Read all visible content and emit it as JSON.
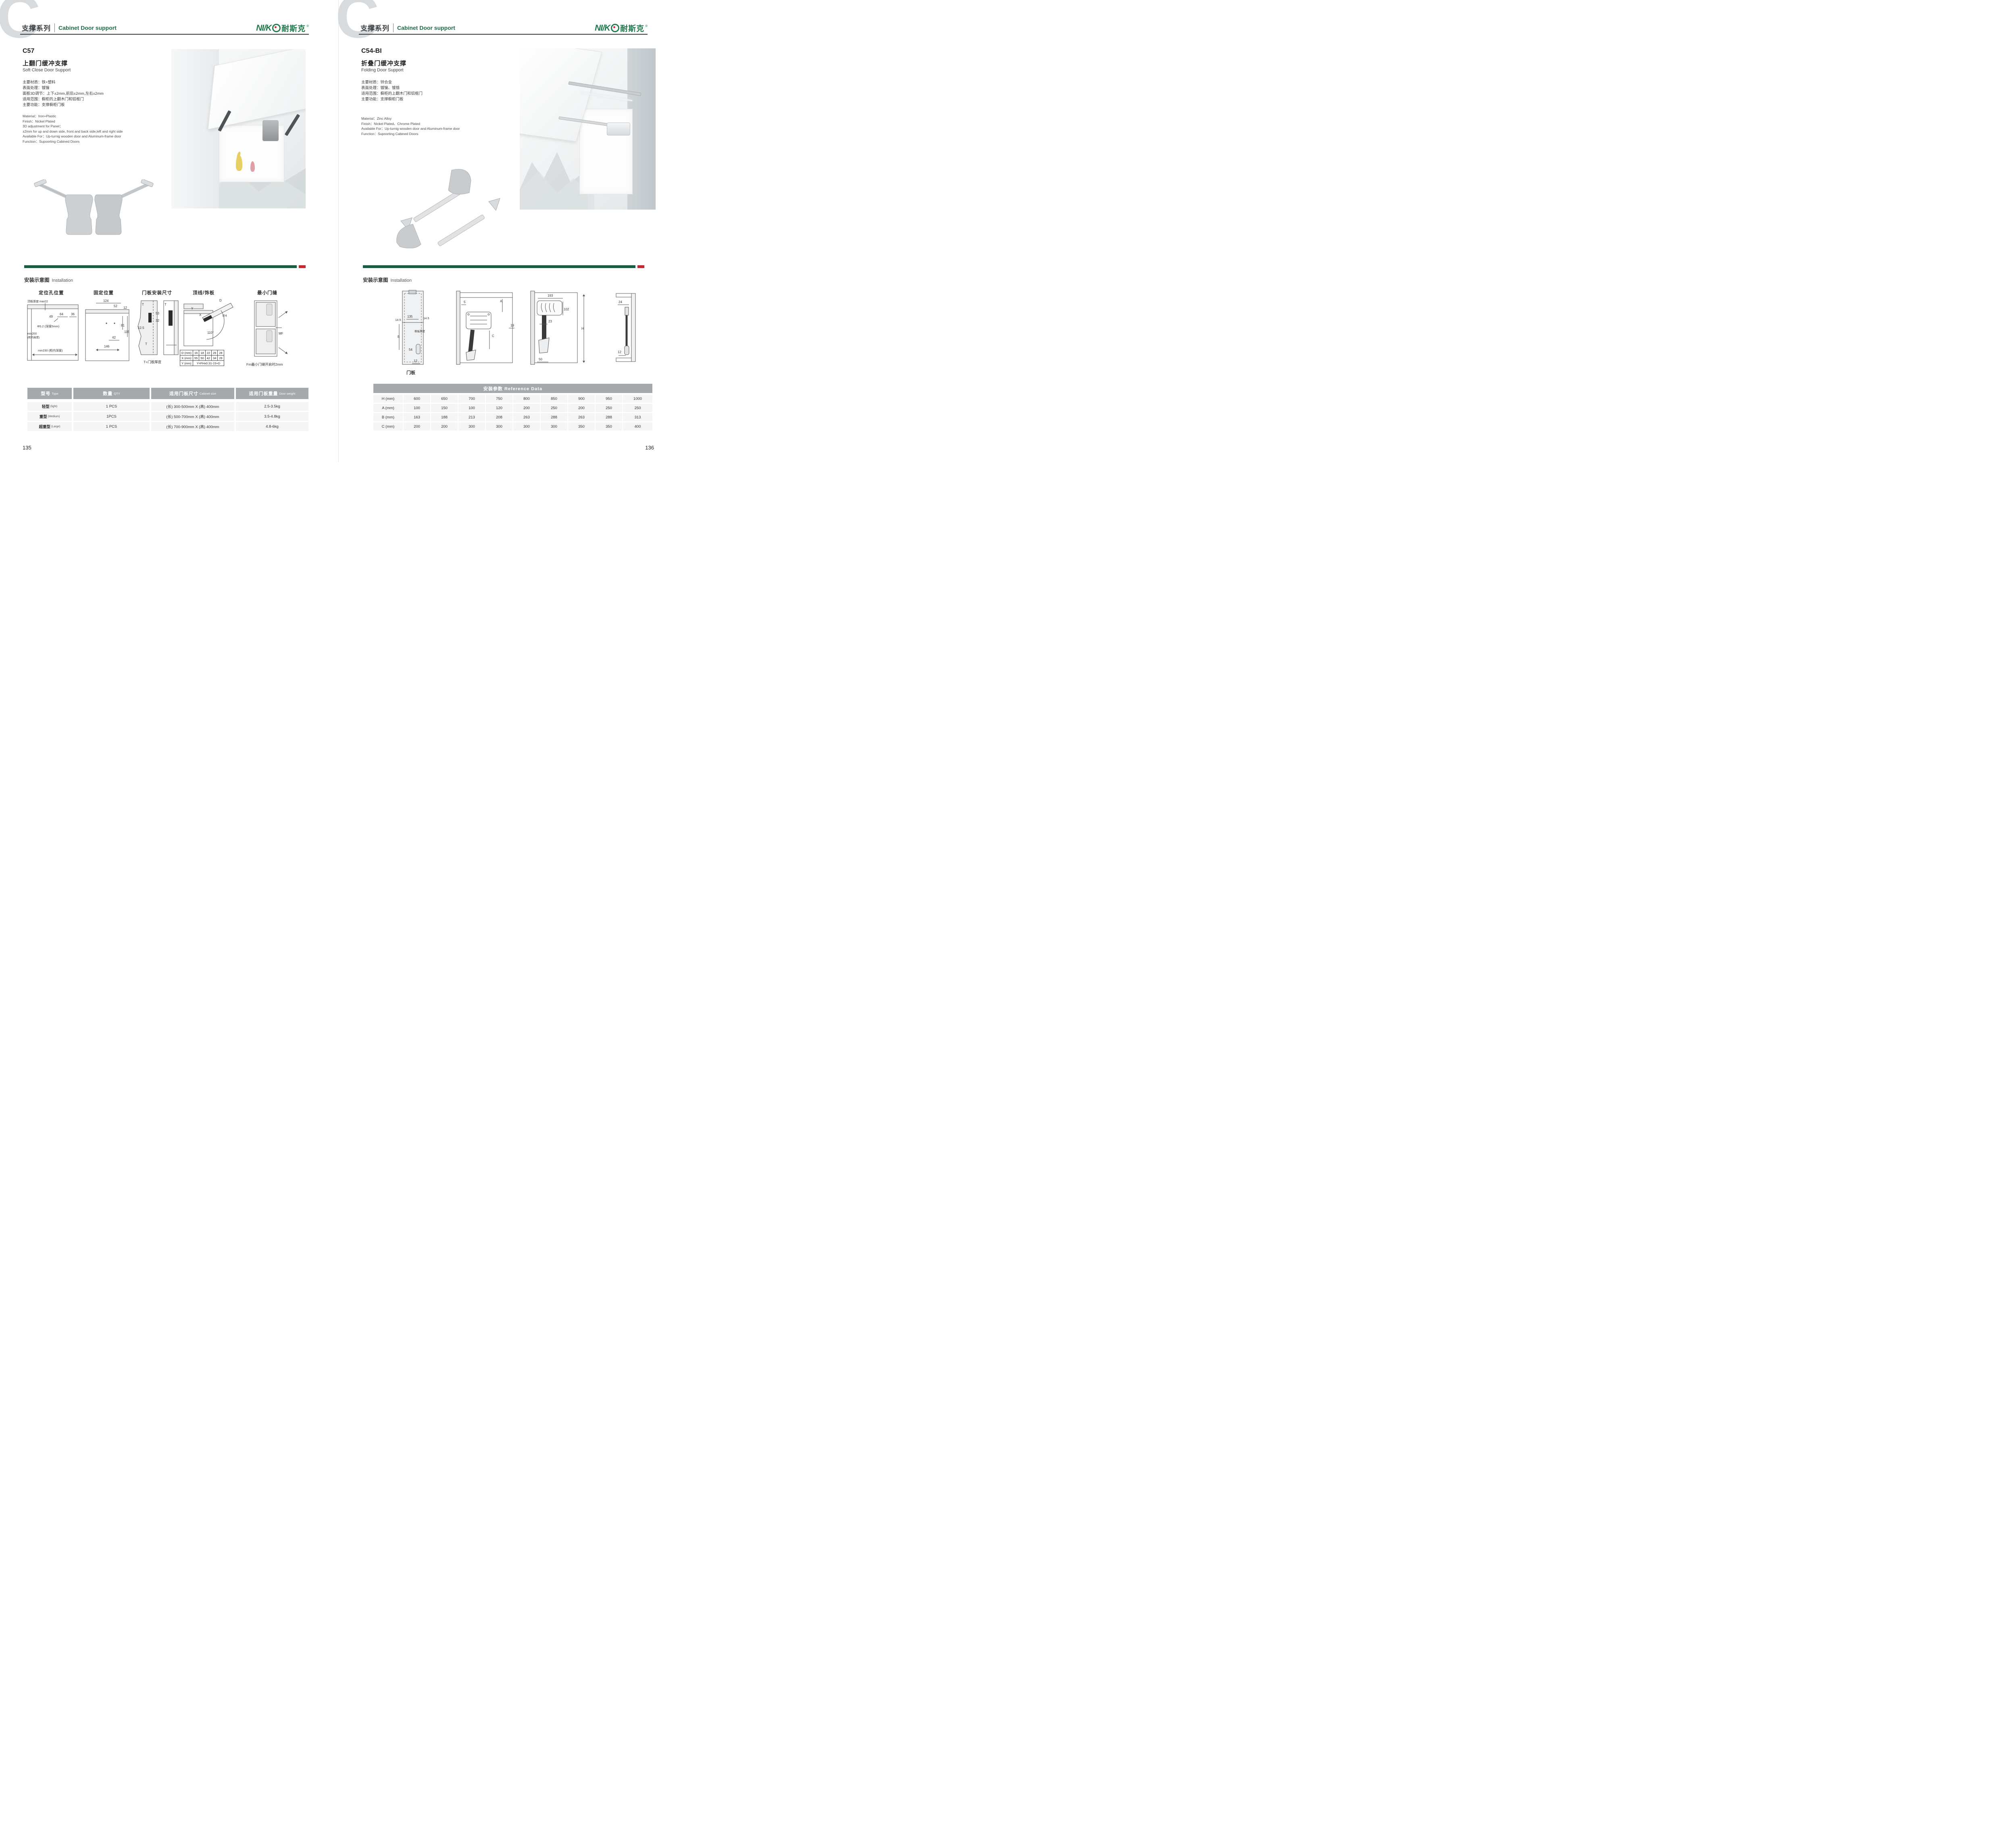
{
  "brand": {
    "logo_latin": "NI/K",
    "logo_cn": "耐斯克",
    "reg": "®",
    "green": "#1e7a4d",
    "red": "#d62b28"
  },
  "header": {
    "watermark": "C",
    "series_cn": "支撑系列",
    "series_en": "Cabinet Door support"
  },
  "install_section": {
    "label_cn": "安装示意图",
    "label_en": "Installation",
    "bar_green": "#1c5c42",
    "bar_red": "#bf2b30"
  },
  "left_page": {
    "model": "C57",
    "title_cn": "上翻门缓冲支撑",
    "title_en": "Soft Close Door Support",
    "specs_cn": [
      "主要材质：铁+塑料",
      "表面处理：镀镍",
      "面板3D调节：上下±2mm,前后±2mm,左右±2mm",
      "适用范围：橱柜的上翻木门和铝框门",
      "主要功能：支撑橱柜门板"
    ],
    "specs_en": [
      "Material：Iron+Plastic",
      "Finish：Nickel Plated",
      "3D adjustment for Panel：",
      "±2mm for up and down side, front and back side,left and right side",
      "Available For：Up-turnig wooden door and Aluminum-frame door",
      "Function：Supoorting Cabined Doors"
    ],
    "diagrams": {
      "d1": {
        "title": "定位孔位置",
        "top_label": "顶板厚度 max22",
        "dim_49": "49",
        "dim_64": "64",
        "dim_36": "36",
        "hole": "Φ5.2 (深度5mm)",
        "min200": "min200",
        "min200_sub": "(柜内高度)",
        "min230": "min230 (柜内深度)"
      },
      "d2": {
        "title": "固定位置",
        "dims": [
          "124",
          "52",
          "12",
          "81",
          "115",
          "42",
          "146"
        ]
      },
      "d3": {
        "title": "门板安装尺寸",
        "dims": [
          "T",
          "53",
          "32",
          "12.5",
          "T",
          "T"
        ],
        "note": "T=门板厚度"
      },
      "d4": {
        "title": "顶线/饰板",
        "dims": [
          "Y",
          "X",
          "D",
          "FH",
          "110°"
        ],
        "table": {
          "r0": [
            "D (mm)",
            "16",
            "18",
            "22",
            "26",
            "28"
          ],
          "r1": [
            "X (mm)",
            "55",
            "50",
            "42",
            "34",
            "29"
          ],
          "r2": [
            "Y (mm)",
            "Y=FHx0.31-15+D"
          ]
        }
      },
      "d5": {
        "title": "最小门缝",
        "mf": "MF",
        "note": "Fm最小门缝开启时2mm"
      }
    },
    "table": {
      "headers": [
        {
          "cn": "型号",
          "en": "Type"
        },
        {
          "cn": "数量",
          "en": "QTY"
        },
        {
          "cn": "适用门板尺寸",
          "en": "Cabinet size"
        },
        {
          "cn": "适用门板重量",
          "en": "Door weight"
        }
      ],
      "rows": [
        {
          "type_cn": "轻型",
          "type_en": "(light)",
          "qty": "1 PCS",
          "size": "(长) 300-500mm X (高) 400mm",
          "weight": "2.5-3.5kg"
        },
        {
          "type_cn": "重型",
          "type_en": "(Medium)",
          "qty": "1PCS",
          "size": "(长) 500-700mm X (高) 400mm",
          "weight": "3.5-4.8kg"
        },
        {
          "type_cn": "超重型",
          "type_en": "(Large)",
          "qty": "1 PCS",
          "size": "(长) 700-900mm X (高) 400mm",
          "weight": "4.8-6kg"
        }
      ]
    },
    "page_number": "135"
  },
  "right_page": {
    "model": "C54-BI",
    "title_cn": "折叠门缓冲支撑",
    "title_en": "Folding Door Support",
    "specs_cn": [
      "主要材质：锌合金",
      "表面处理：镀镍、镀铬",
      "适用范围：橱柜的上翻木门和铝框门",
      "主要功能：支撑橱柜门板"
    ],
    "specs_en": [
      "Material：Zinc Alloy",
      "Finish：Nickel Plated、Chrome Plated",
      "Available For：Up-turnig wooden door and Aluminum-frame door",
      "Function：Supoorting Cabined Doors"
    ],
    "diagrams": {
      "d1": {
        "label": "门板",
        "dim_135": "135",
        "dim_145l": "14.5",
        "dim_145r": "14.5",
        "dim_B": "B",
        "side_label": "侧板厚度",
        "dim_54": "54",
        "dim_12": "12"
      },
      "d2": {
        "dim_5": "5",
        "dim_A": "A",
        "dim_C": "C",
        "dim_19": "19"
      },
      "d3": {
        "dim_193": "193",
        "dim_102": "102",
        "dim_23": "23",
        "dim_H": "H",
        "dim_50": "50"
      },
      "d4": {
        "dim_24": "24",
        "dim_12": "12"
      }
    },
    "table": {
      "title": "安装参数 Reference Data",
      "rows": [
        {
          "label": "H (mm)",
          "values": [
            "600",
            "650",
            "700",
            "750",
            "800",
            "850",
            "900",
            "950",
            "1000"
          ]
        },
        {
          "label": "A (mm)",
          "values": [
            "100",
            "150",
            "100",
            "120",
            "200",
            "250",
            "200",
            "250",
            "250"
          ]
        },
        {
          "label": "B (mm)",
          "values": [
            "163",
            "188",
            "213",
            "208",
            "263",
            "288",
            "263",
            "288",
            "313"
          ]
        },
        {
          "label": "C (mm)",
          "values": [
            "200",
            "200",
            "300",
            "300",
            "300",
            "300",
            "350",
            "350",
            "400"
          ]
        }
      ]
    },
    "page_number": "136"
  }
}
